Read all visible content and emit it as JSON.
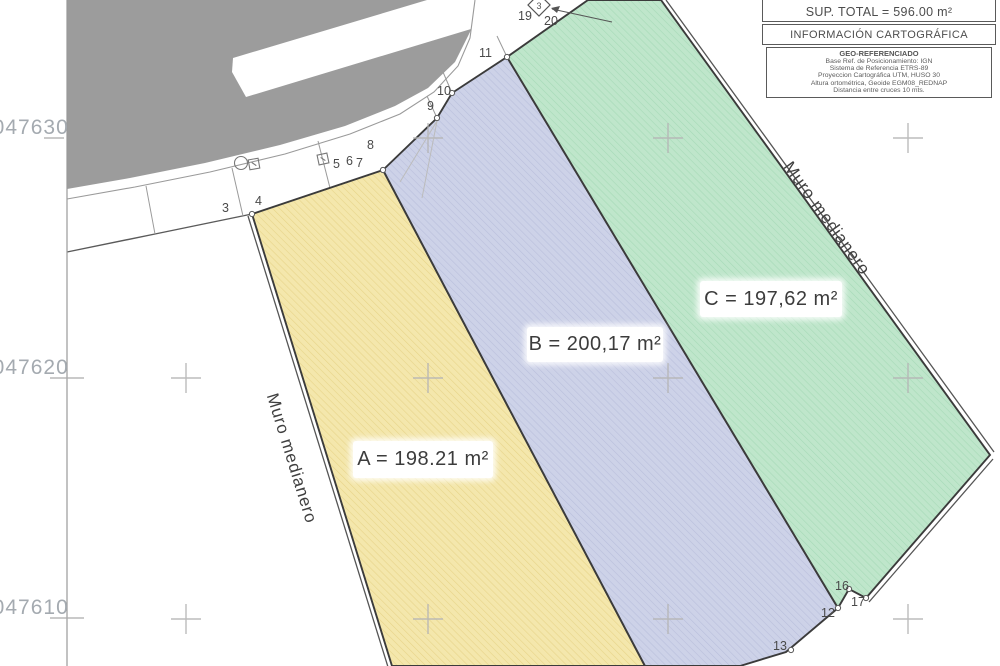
{
  "info_box": {
    "sup_total": "SUP. TOTAL = 596.00 m²",
    "carto_title": "INFORMACIÓN CARTOGRÁFICA",
    "geo_title": "GEO-REFERENCIADO",
    "geo_lines": [
      "Base Ref. de Posicionamiento: IGN",
      "Sistema de Referencia ETRS-89",
      "Proyeccion Cartográfica UTM, HUSO 30",
      "Altura ortométrica, Geoide EGM08_REDNAP",
      "Distancia entre cruces 10 mts."
    ]
  },
  "parcels": [
    {
      "id": "A",
      "area_label": "A = 198.21 m²",
      "fill": "#f4e7ac",
      "hatch": "#e7d489"
    },
    {
      "id": "B",
      "area_label": "B = 200,17 m²",
      "fill": "#cdd2e8",
      "hatch": "#b9bfdc"
    },
    {
      "id": "C",
      "area_label": "C = 197,62 m²",
      "fill": "#bfe6cb",
      "hatch": "#a6dab7"
    }
  ],
  "wall_labels": [
    "Muro medianero",
    "Muro medianero"
  ],
  "grid_coordinates": [
    "4047630",
    "4047620",
    "4047610"
  ],
  "grid_note": "crosses every 10 m",
  "point_labels": {
    "p3": "3",
    "p4": "4",
    "p5": "5",
    "p6": "6",
    "p7": "7",
    "p8": "8",
    "p9": "9",
    "p10": "10",
    "p11": "11",
    "p12": "12",
    "p13": "13",
    "p16": "16",
    "p17": "17",
    "p19": "19",
    "p20": "20"
  },
  "station_label": "3",
  "colors": {
    "street_gray": "#9c9c9c",
    "boundary": "#3b3b3b",
    "grid_cross": "#b5b5b5",
    "coordinate_text": "#a4aab0"
  }
}
